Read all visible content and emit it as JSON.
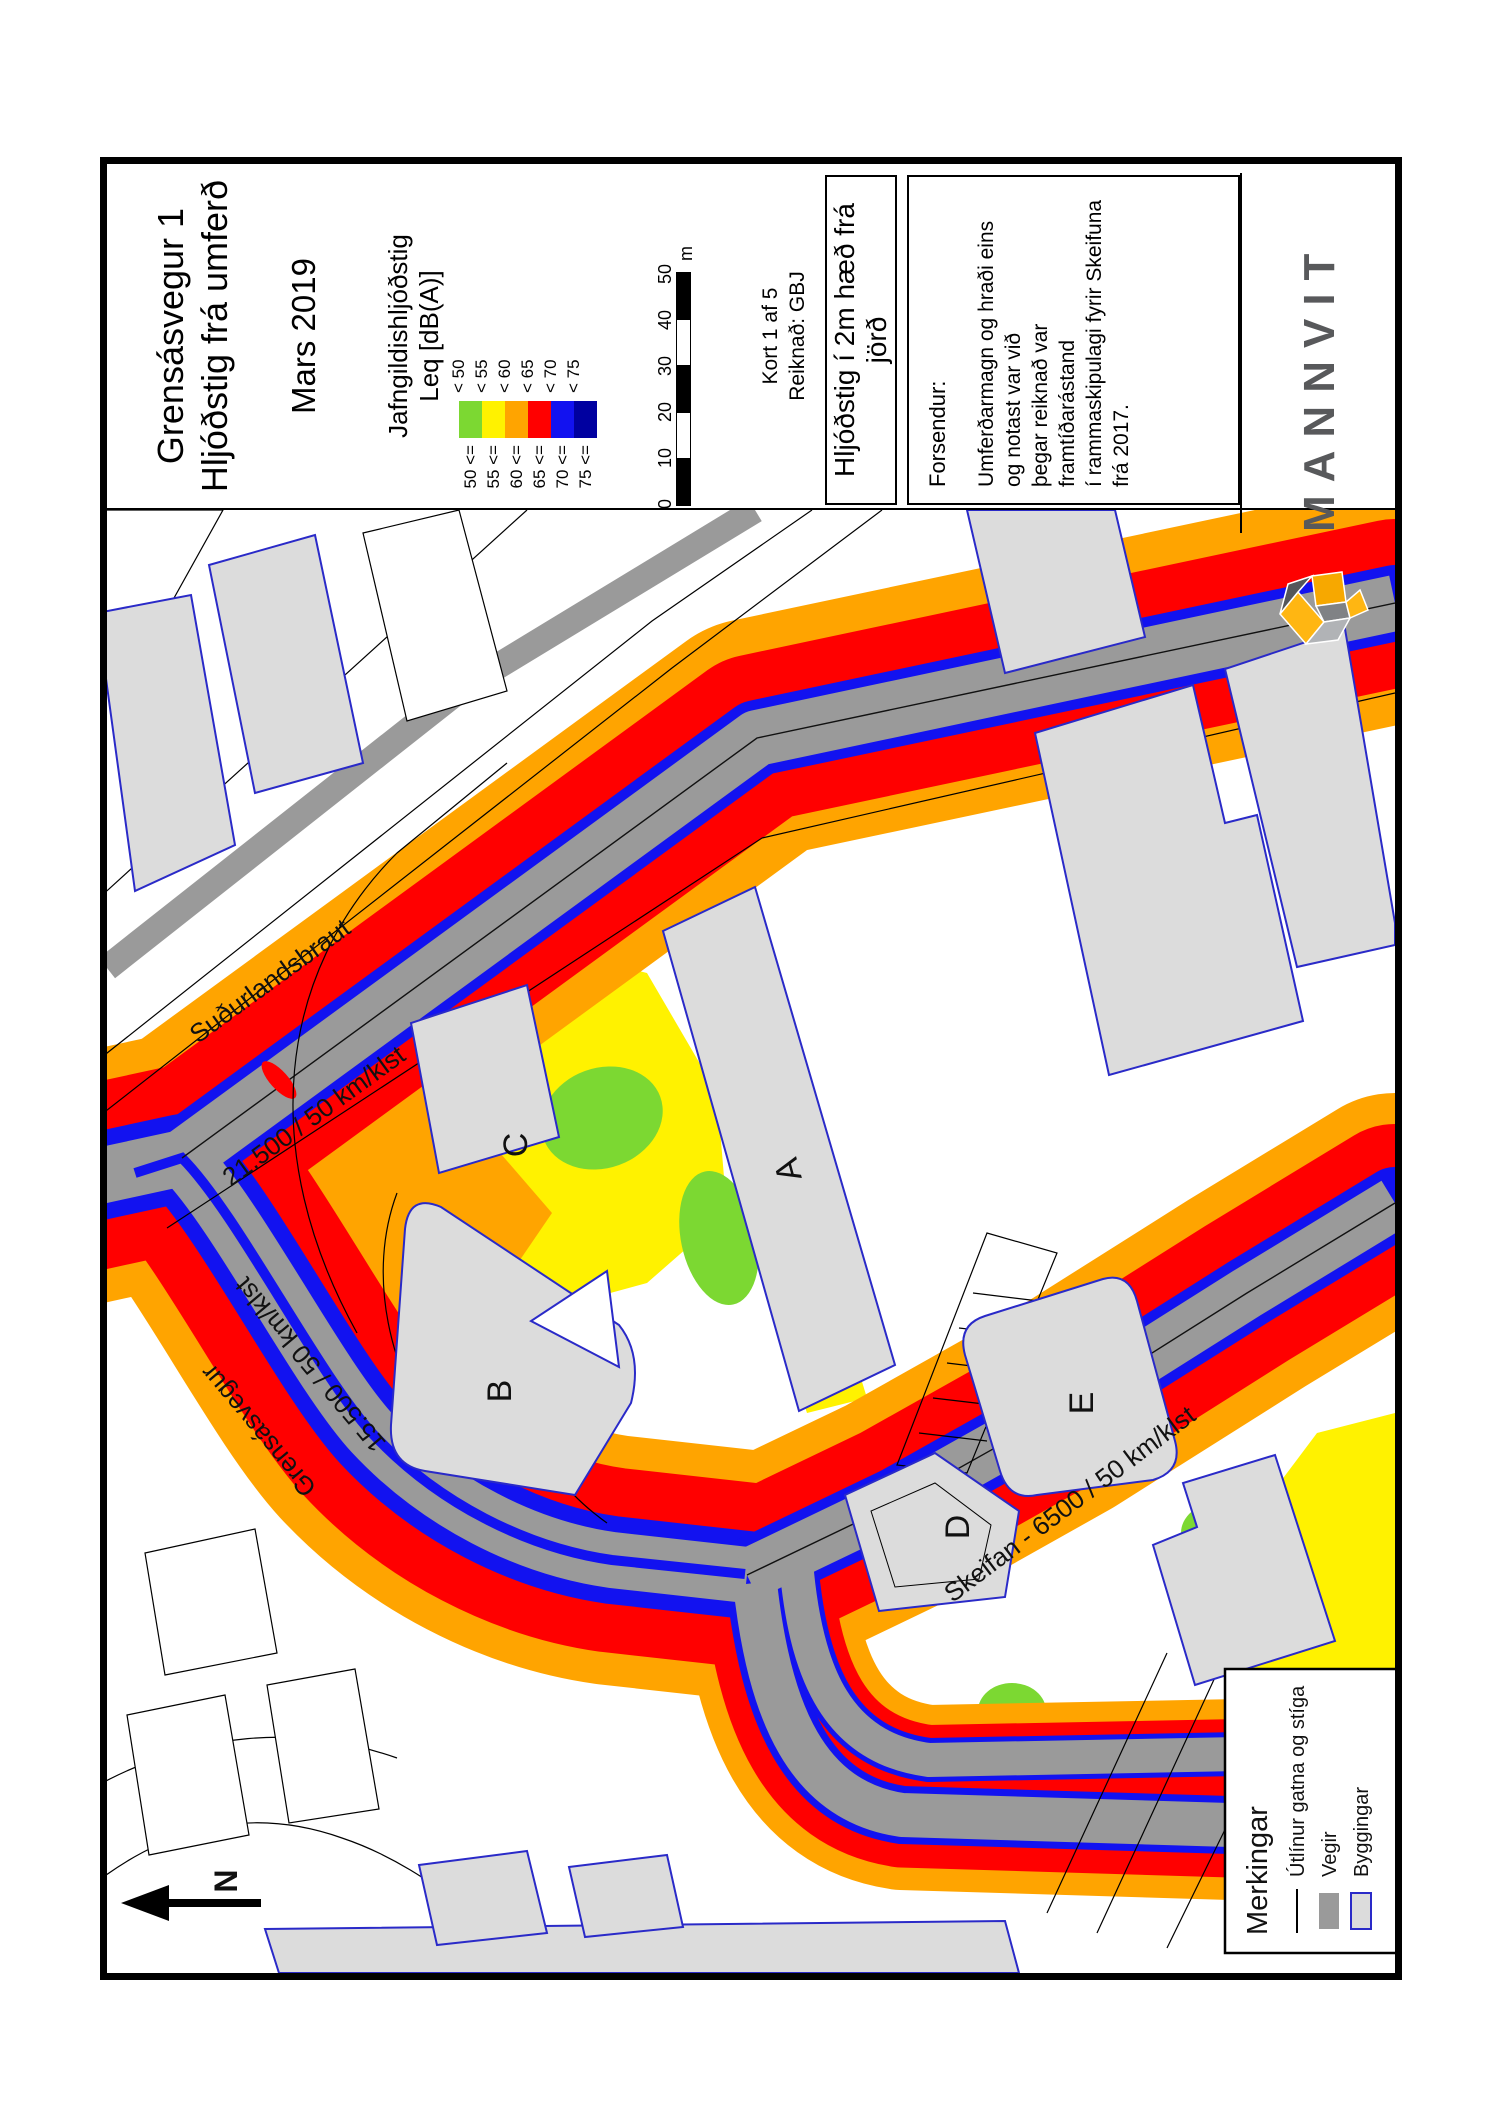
{
  "title": {
    "line1": "Grensásvegur 1",
    "line2": "Hljóðstig frá umferð",
    "date": "Mars 2019"
  },
  "legend": {
    "title1": "Jafngildishljóðstig",
    "title2": "Leq [dB(A)]",
    "bands": [
      {
        "lt": "< 50",
        "ge": "50 <=",
        "color": "#7CD832"
      },
      {
        "lt": "< 55",
        "ge": "55 <=",
        "color": "#FFF200"
      },
      {
        "lt": "< 60",
        "ge": "60 <=",
        "color": "#FFA400"
      },
      {
        "lt": "< 65",
        "ge": "65 <=",
        "color": "#FF0000"
      },
      {
        "lt": "< 70",
        "ge": "70 <=",
        "color": "#1212F0"
      },
      {
        "lt": "< 75",
        "ge": "75 <=",
        "color": "#0000A0"
      }
    ]
  },
  "scalebar": {
    "ticks": [
      "0",
      "10",
      "20",
      "30",
      "40",
      "50"
    ],
    "unit": "m"
  },
  "sheetinfo": {
    "kort": "Kort 1 af 5",
    "reiknad": "Reiknað: GBJ"
  },
  "map_title_box": "Hljóðstig í 2m hæð frá jörð",
  "assumptions": {
    "label": "Forsendur:",
    "line1": "Umferðarmagn og hraði eins og notast var við",
    "line2": "þegar reiknað var framtíðarástand",
    "line3": "í rammaskipulagi fyrir Skeifuna frá 2017."
  },
  "logo": {
    "wordmark": "MANNVIT"
  },
  "map": {
    "north_label": "N",
    "road_labels": {
      "sudurlandsbraut": "Suðurlandsbraut",
      "sudurlandsbraut_traffic": "21.500 / 50 km/klst",
      "grensasvegur": "Grensásvegur",
      "grensasvegur_traffic": "15.500 / 50 km/klst",
      "skeifan": "Skeifan - 6500 / 50 km/klst"
    },
    "building_labels": {
      "a": "A",
      "b": "B",
      "c": "C",
      "d": "D",
      "e": "E"
    }
  },
  "map_legend": {
    "title": "Merkingar",
    "item_outlines": "Útlínur gatna og stíga",
    "item_roads": "Vegir",
    "item_buildings": "Byggingar"
  },
  "colors": {
    "noise_green": "#7CD832",
    "noise_yellow": "#FFF200",
    "noise_orange": "#FFA400",
    "noise_red": "#FF0000",
    "noise_blue": "#1212F0",
    "noise_navy": "#0000A0",
    "road_gray": "#9A9A9A",
    "building_fill": "#DCDCDC",
    "building_stroke": "#2A2AC8",
    "logo_gray": "#58595B",
    "logo_yellow": "#FFB612",
    "logo_orange": "#F7A800"
  }
}
